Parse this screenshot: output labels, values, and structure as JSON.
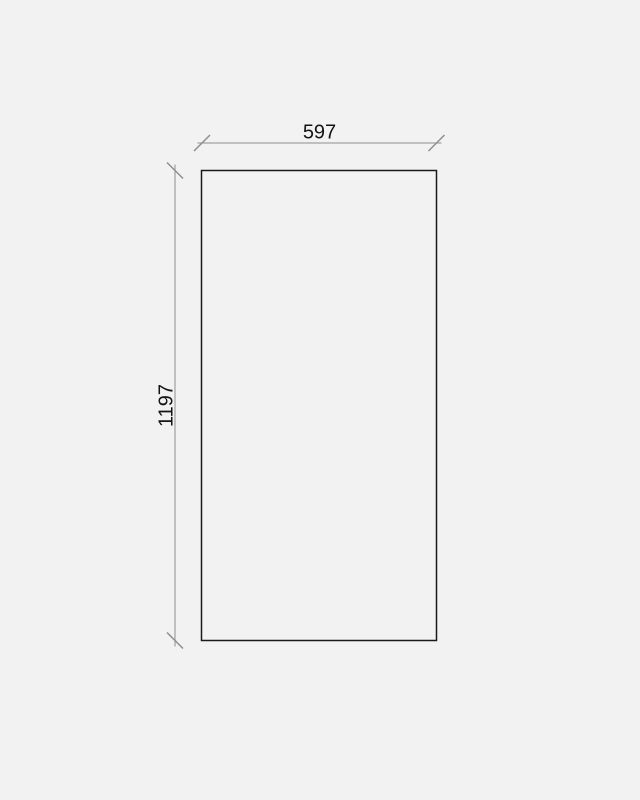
{
  "page": {
    "background_color": "#f1f2f1"
  },
  "drawing": {
    "shape": "rectangular-panel-outline",
    "outline_color": "#1a1a1a",
    "dimension_line_color": "#8f8f8f",
    "label_color": "#141414",
    "width_label": "597",
    "height_label": "1197"
  }
}
